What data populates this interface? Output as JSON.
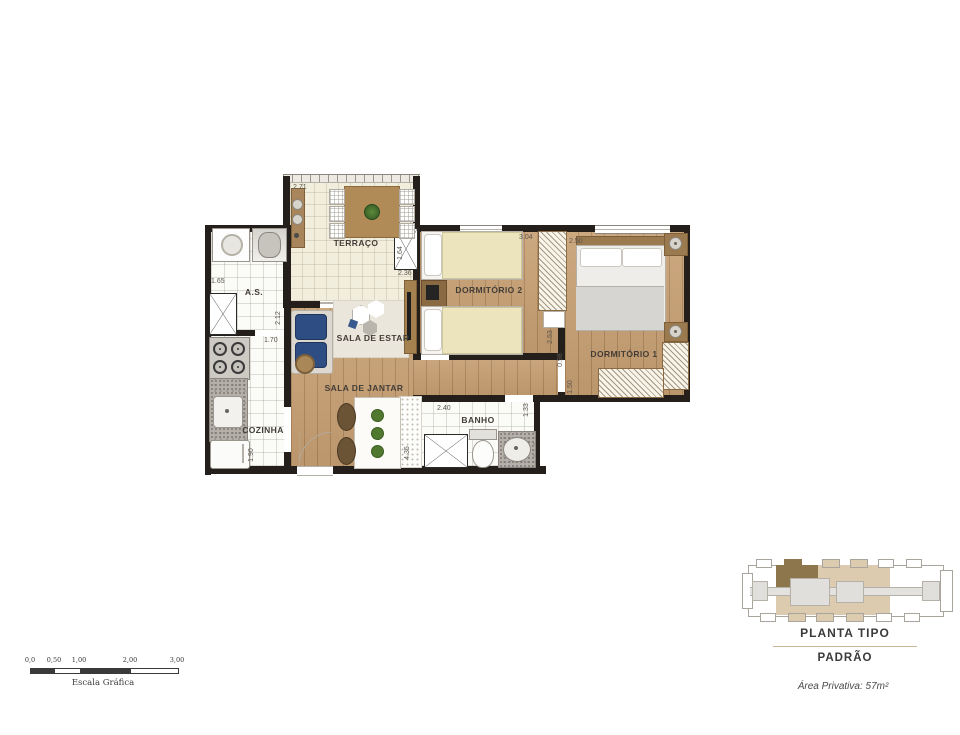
{
  "rooms": {
    "terraco": "TERRAÇO",
    "as": "A.S.",
    "sala_estar": "SALA DE ESTAR",
    "dormitorio2": "DORMITÓRIO 2",
    "dormitorio1": "DORMITÓRIO 1",
    "sala_jantar": "SALA DE JANTAR",
    "cozinha": "COZINHA",
    "banho": "BANHO"
  },
  "dims": {
    "terraco_w": "2.71",
    "shaft_h": "1.64",
    "as_w": "1.65",
    "as_h": "2.12",
    "as_door": "1.70",
    "estar_w": "2.36",
    "dorm2_w": "3.04",
    "dorm2_h": "2.53",
    "hall_w": "0.98",
    "dorm1_w": "2.50",
    "dorm1_closet": "1.50",
    "jantar_h": "4.35",
    "cozinha_h": "1.90",
    "banho_w": "2.40",
    "banho_h": "1.33"
  },
  "scalebar": {
    "ticks": [
      "0,0",
      "0,50",
      "1,00",
      "2,00",
      "3,00"
    ],
    "caption": "Escala Gráfica"
  },
  "legend": {
    "title": "PLANTA TIPO",
    "subtitle": "PADRÃO",
    "area_label": "Área Privativa: 57m²"
  },
  "colors": {
    "wall": "#241f1b",
    "wood_floor": "#c79f72",
    "highlight_unit": "#8d764c",
    "keyplan_beige": "#dccbae",
    "sofa_blue": "#2e4d82"
  }
}
